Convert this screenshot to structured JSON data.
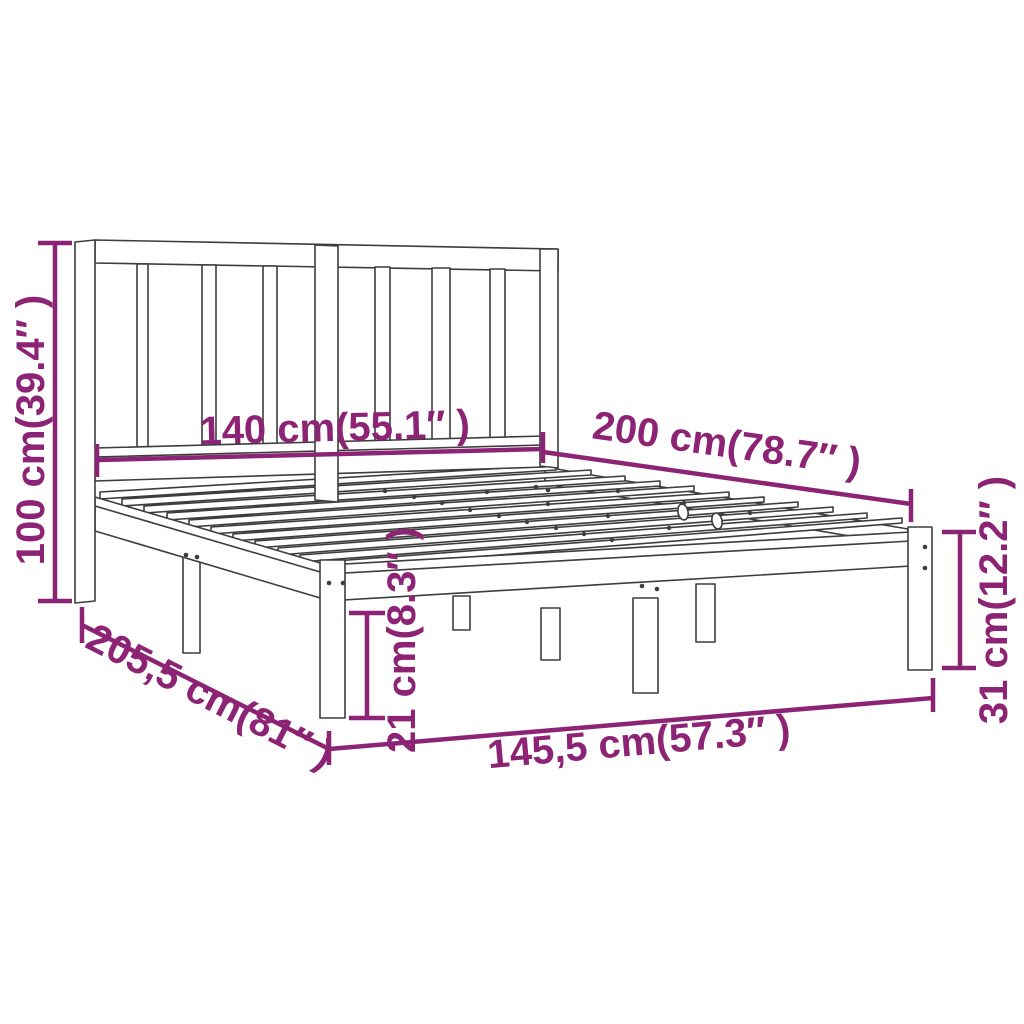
{
  "diagram": {
    "kind": "furniture-dimension-diagram",
    "subject": "bed-frame-with-headboard",
    "background_color": "#ffffff",
    "line_color": "#3d3d3d",
    "dimension_color": "#8D2374",
    "dimensions": {
      "headboard_height": {
        "cm": "100 cm",
        "inch": "39.4″",
        "label": "100 cm(39.4″ )"
      },
      "bed_width": {
        "cm": "140 cm",
        "inch": "55.1″",
        "label": "140 cm(55.1″ )"
      },
      "bed_length": {
        "cm": "200 cm",
        "inch": "78.7″",
        "label": "200 cm(78.7″ )"
      },
      "side_height": {
        "cm": "31 cm",
        "inch": "12.2″",
        "label": "31 cm(12.2″ )"
      },
      "total_length": {
        "cm": "205,5 cm",
        "inch": "81″",
        "label": "205,5 cm(81″ )"
      },
      "leg_height": {
        "cm": "21 cm",
        "inch": "8.3″",
        "label": "21 cm(8.3″ )"
      },
      "total_width": {
        "cm": "145,5 cm",
        "inch": "57.3″",
        "label": "145,5 cm(57.3″ )"
      }
    }
  }
}
